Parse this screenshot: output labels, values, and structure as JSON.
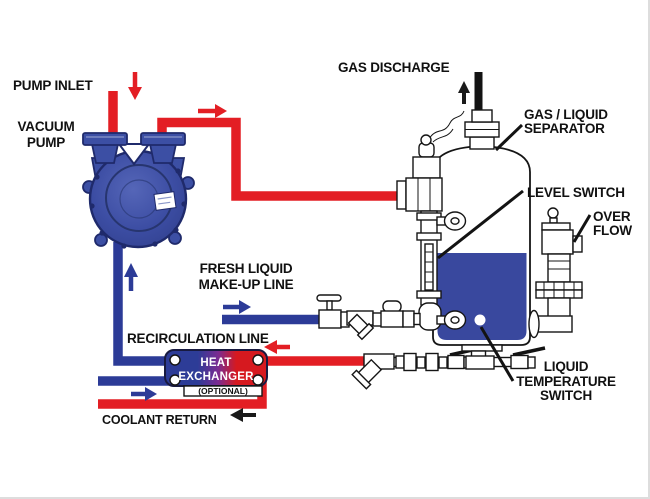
{
  "labels": {
    "pump_inlet": "PUMP INLET",
    "vacuum_pump": [
      "VACUUM",
      "PUMP"
    ],
    "gas_discharge": "GAS DISCHARGE",
    "gas_liquid_separator": [
      "GAS / LIQUID",
      "SEPARATOR"
    ],
    "level_switch": "LEVEL SWITCH",
    "over_flow": [
      "OVER",
      "FLOW"
    ],
    "fresh_liquid_makeup": [
      "FRESH LIQUID",
      "MAKE-UP LINE"
    ],
    "recirculation_line": "RECIRCULATION LINE",
    "heat_exchanger": [
      "HEAT",
      "EXCHANGER"
    ],
    "heat_exchanger_note": "(OPTIONAL)",
    "coolant_return": "COOLANT RETURN",
    "liquid_temperature_switch": [
      "LIQUID",
      "TEMPERATURE",
      "SWITCH"
    ]
  },
  "colors": {
    "pipe_red": "#e31e24",
    "pipe_blue": "#2c3b97",
    "pump_blue": "#3c4fa4",
    "pump_dark": "#1f2a6b",
    "liquid_blue": "#39489e",
    "hx_blue": "#2d3c97",
    "hx_purple": "#7a2b92",
    "hx_red": "#d6191f",
    "arrow_black": "#1a1a1a"
  }
}
